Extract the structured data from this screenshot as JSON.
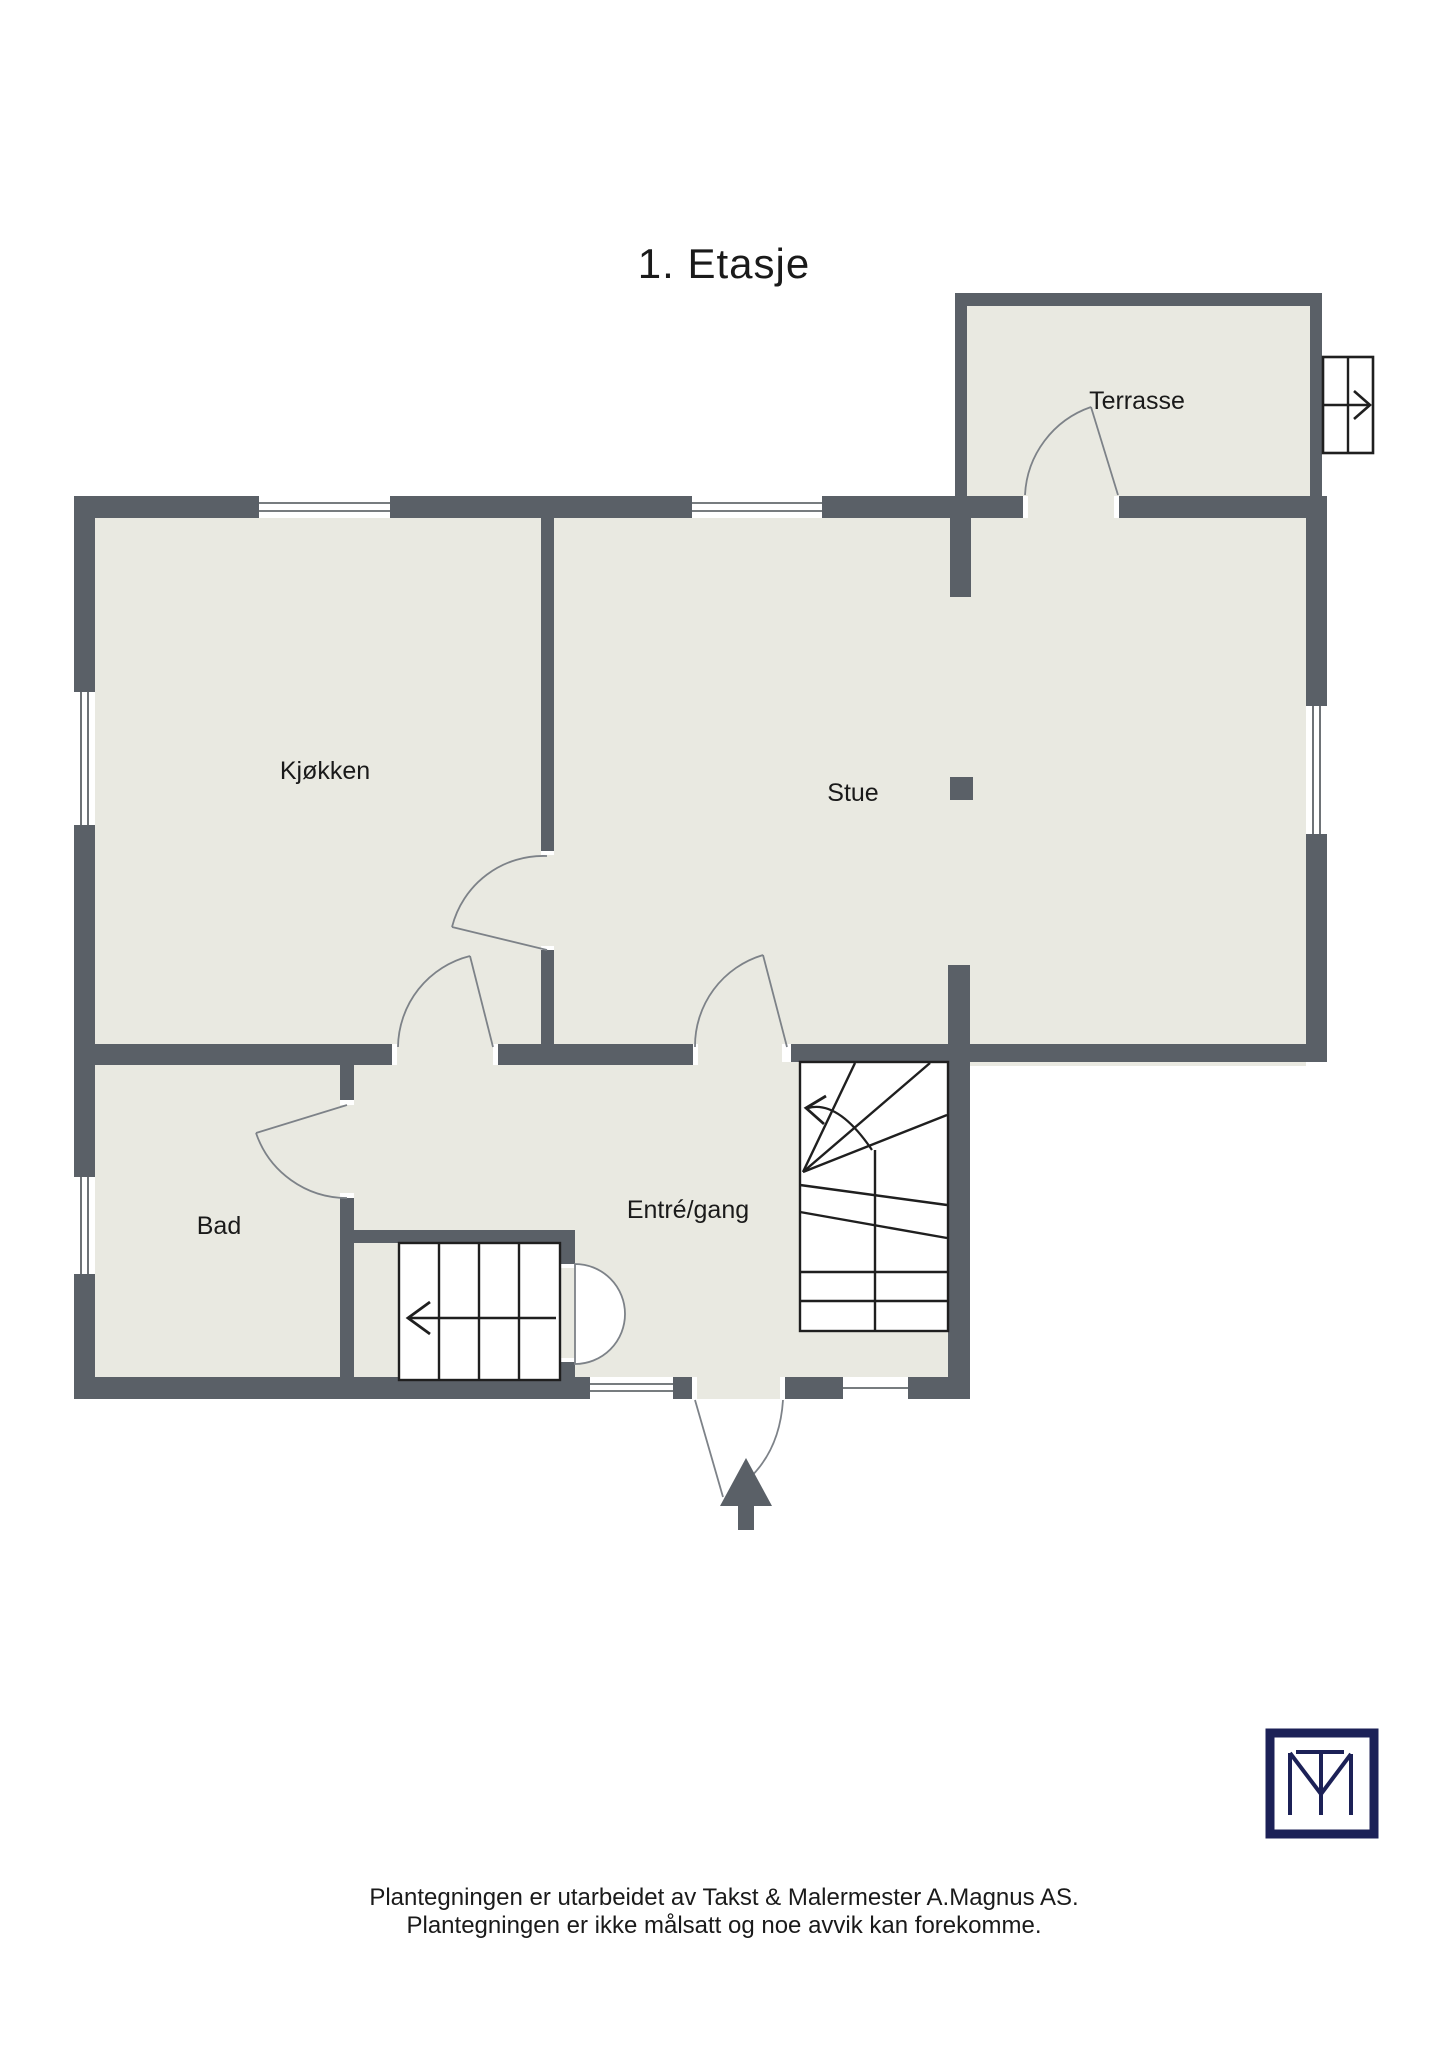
{
  "title": "1. Etasje",
  "rooms": {
    "kjokken": {
      "label": "Kjøkken"
    },
    "stue": {
      "label": "Stue"
    },
    "terrasse": {
      "label": "Terrasse"
    },
    "bad": {
      "label": "Bad"
    },
    "entre": {
      "label": "Entré/gang"
    }
  },
  "footer": {
    "line1": "Plantegningen er utarbeidet av Takst & Malermester A.Magnus AS.",
    "line2": "Plantegningen er ikke målsatt og noe avvik kan forekomme."
  },
  "logo": {
    "monogram": "TM"
  },
  "icons": {
    "entrance_arrow": "entrance-direction-arrow",
    "stair_up_left": "stairs-direction-arrow-left",
    "exterior_stairs": "exterior-stairs-arrow-right"
  },
  "colors": {
    "wall": "#5a6067",
    "floor": "#e9e9e1",
    "outside": "#ffffff",
    "stair_lines": "#1f1f1f",
    "door_arc": "#7d8288",
    "logo_navy": "#1c2157",
    "text": "#1a1a1a"
  }
}
